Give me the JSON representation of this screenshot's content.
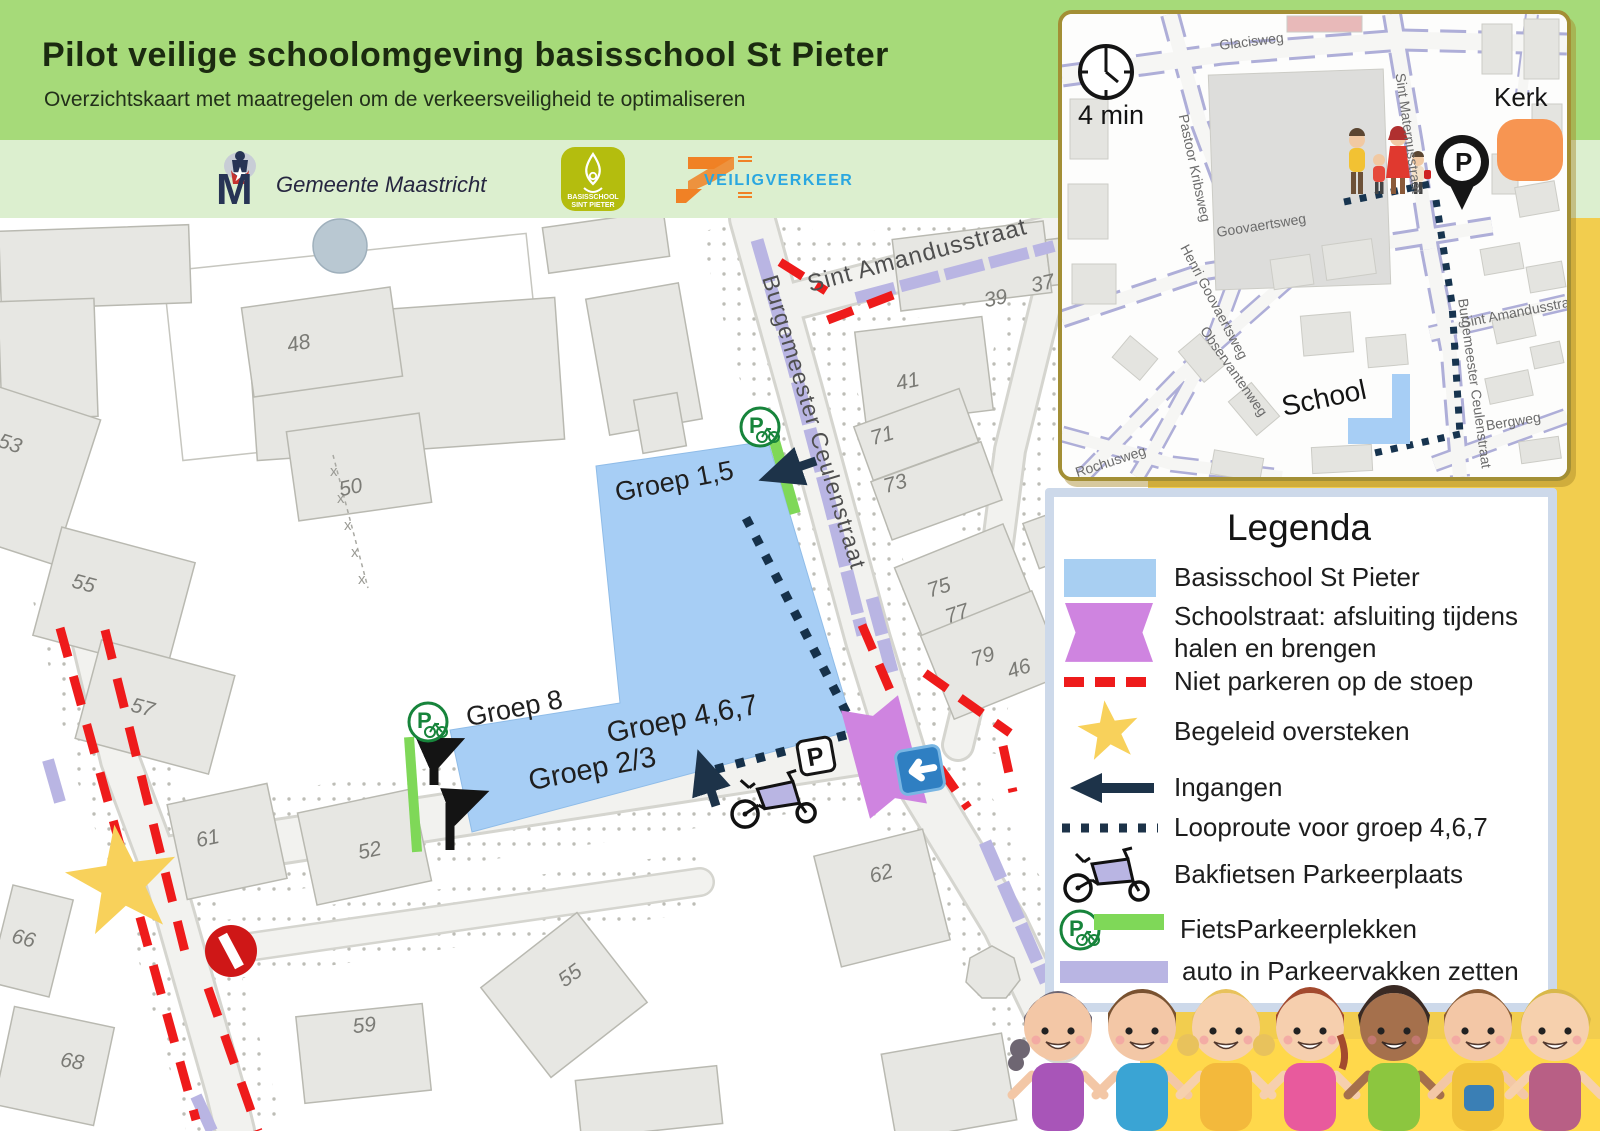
{
  "header": {
    "title": "Pilot veilige schoolomgeving basisschool St Pieter",
    "subtitle": "Overzichtskaart met maatregelen om de verkeersveiligheid te optimaliseren"
  },
  "logos": {
    "gemeente": {
      "name": "Gemeente Maastricht"
    },
    "school": {
      "line1": "BASISSCHOOL",
      "line2": "SINT PIETER"
    },
    "veiligverkeer": {
      "name": "VEILIGVERKEER"
    }
  },
  "inset": {
    "walk_time": "4 min",
    "labels": {
      "kerk": "Kerk",
      "school": "School"
    },
    "streets": [
      "Glacisweg",
      "Pastoor Kribsweg",
      "Sint Maternusstraat",
      "Goovaertsweg",
      "Henri Goovaertsweg",
      "Observantenweg",
      "Rochusweg",
      "Sint Amandusstraat",
      "Bergweg",
      "Burgemeester Ceulenstraat"
    ]
  },
  "map": {
    "streets": {
      "amandus": "Sint Amandusstraat",
      "ceulen": "Burgemeester Ceulenstraat"
    },
    "groups": {
      "g15": "Groep 1,5",
      "g8": "Groep 8",
      "g23": "Groep 2/3",
      "g467": "Groep 4,6,7"
    },
    "houses": [
      {
        "n": "48"
      },
      {
        "n": "50"
      },
      {
        "n": "39"
      },
      {
        "n": "37"
      },
      {
        "n": "41"
      },
      {
        "n": "71"
      },
      {
        "n": "73"
      },
      {
        "n": "75"
      },
      {
        "n": "77"
      },
      {
        "n": "79"
      },
      {
        "n": "46"
      },
      {
        "n": "53"
      },
      {
        "n": "55"
      },
      {
        "n": "57"
      },
      {
        "n": "61"
      },
      {
        "n": "52"
      },
      {
        "n": "66"
      },
      {
        "n": "68"
      },
      {
        "n": "59"
      },
      {
        "n": "55"
      },
      {
        "n": "62"
      }
    ]
  },
  "legend": {
    "title": "Legenda",
    "items": [
      {
        "label": "Basisschool St Pieter"
      },
      {
        "label": "Schoolstraat: afsluiting tijdens halen en brengen"
      },
      {
        "label": "Niet parkeren op de stoep"
      },
      {
        "label": "Begeleid oversteken"
      },
      {
        "label": "Ingangen"
      },
      {
        "label": "Looproute voor groep 4,6,7"
      },
      {
        "label": "Bakfietsen Parkeerplaats"
      },
      {
        "label": "FietsParkeerplekken"
      },
      {
        "label": "auto in Parkeervakken zetten"
      }
    ]
  },
  "icons": {
    "p_letter": "P"
  },
  "colors": {
    "header_green": "#a6da79",
    "logo_band_green": "#dcefcf",
    "gold_panel": "#f2cd4e",
    "kids_banner_yellow": "#ffd84b",
    "school_blue": "#a7cef5",
    "schoolstraat_purple": "#cf84e0",
    "no_parking_red": "#ee1b1b",
    "route_navy": "#1d3349",
    "bike_parking_green": "#7fd858",
    "car_parking_lavender": "#b9b5e3",
    "legend_border_blue": "#cdd9ea",
    "kerk_orange": "#f79552"
  }
}
